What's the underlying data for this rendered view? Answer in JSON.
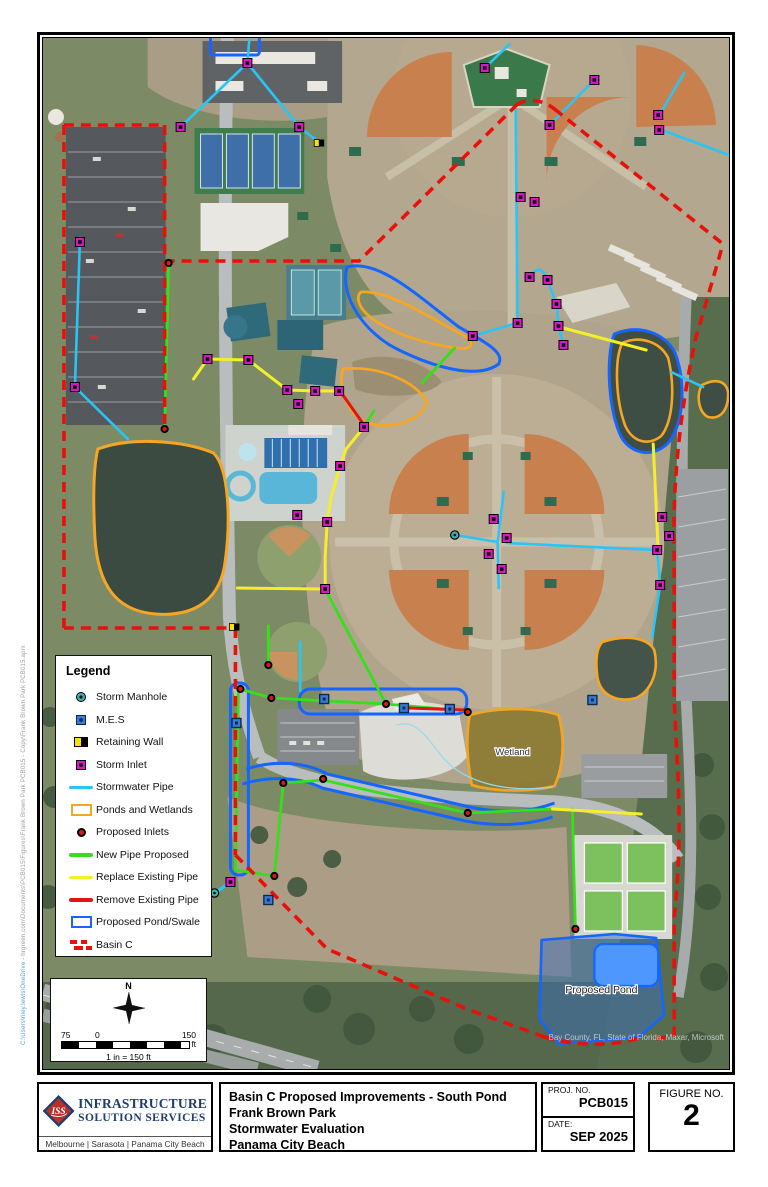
{
  "map": {
    "labels": {
      "wetland": "Wetland",
      "proposed_pond": "Proposed Pond"
    },
    "attribution": "Bay County, FL, State of Florida, Maxar, Microsoft",
    "file_path_head": "C:\\Users\\riley.lewis\\OneDrive",
    "file_path_tail": " - hrgreen.com\\Documents\\PCB015\\Figures\\Frank Brown Park PCB015 - Copy\\Frank Brown Park PCB015.aprx"
  },
  "legend": {
    "title": "Legend",
    "items": [
      {
        "label": "Storm Manhole",
        "swatch": "manhole",
        "color": "#39b5ad"
      },
      {
        "label": "M.E.S",
        "swatch": "mes",
        "color": "#3a7bd5"
      },
      {
        "label": "Retaining Wall",
        "swatch": "retwall",
        "color": "#f7e300"
      },
      {
        "label": "Storm Inlet",
        "swatch": "inlet",
        "color": "#d816c8"
      },
      {
        "label": "Stormwater Pipe",
        "swatch": "line",
        "color": "#29c5f6"
      },
      {
        "label": "Ponds and Wetlands",
        "swatch": "rect",
        "color": "#f5a623"
      },
      {
        "label": "Proposed Inlets",
        "swatch": "dot",
        "color": "#e01616"
      },
      {
        "label": "New Pipe Proposed",
        "swatch": "line",
        "color": "#35e01a"
      },
      {
        "label": "Replace Existing Pipe",
        "swatch": "line",
        "color": "#f5ee2a"
      },
      {
        "label": "Remove Existing Pipe",
        "swatch": "line",
        "color": "#e01616"
      },
      {
        "label": "Proposed Pond/Swale",
        "swatch": "rect",
        "color": "#1565ff"
      },
      {
        "label": "Basin C",
        "swatch": "dash",
        "color": "#e8110a"
      }
    ]
  },
  "scale_bar": {
    "north": "N",
    "left": "75",
    "zero": "0",
    "right": "150",
    "unit": "ft",
    "ratio": "1 in = 150 ft"
  },
  "title_block": {
    "company": {
      "logo_text": "ISS",
      "name_line1": "INFRASTRUCTURE",
      "name_line2": "SOLUTION SERVICES",
      "locations": "Melbourne | Sarasota | Panama City Beach"
    },
    "title_line1": "Basin C Proposed Improvements - South Pond",
    "title_line2": "Frank Brown Park",
    "title_line3": "Stormwater Evaluation",
    "title_line4": "Panama City Beach",
    "proj_label": "PROJ. NO.",
    "proj_no": "PCB015",
    "date_label": "DATE:",
    "date": "SEP 2025",
    "figure_label": "FIGURE NO.",
    "figure_no": "2"
  },
  "colors": {
    "stormwater_pipe": "#29c5f6",
    "new_pipe": "#35e01a",
    "replace_pipe": "#f5ee2a",
    "remove_pipe": "#e01616",
    "ponds_wetlands": "#f5a623",
    "proposed_pond_swale": "#1565ff",
    "basin_c": "#e8110a",
    "storm_inlet": "#d816c8",
    "mes": "#3a7bd5",
    "storm_manhole": "#39b5ad"
  }
}
